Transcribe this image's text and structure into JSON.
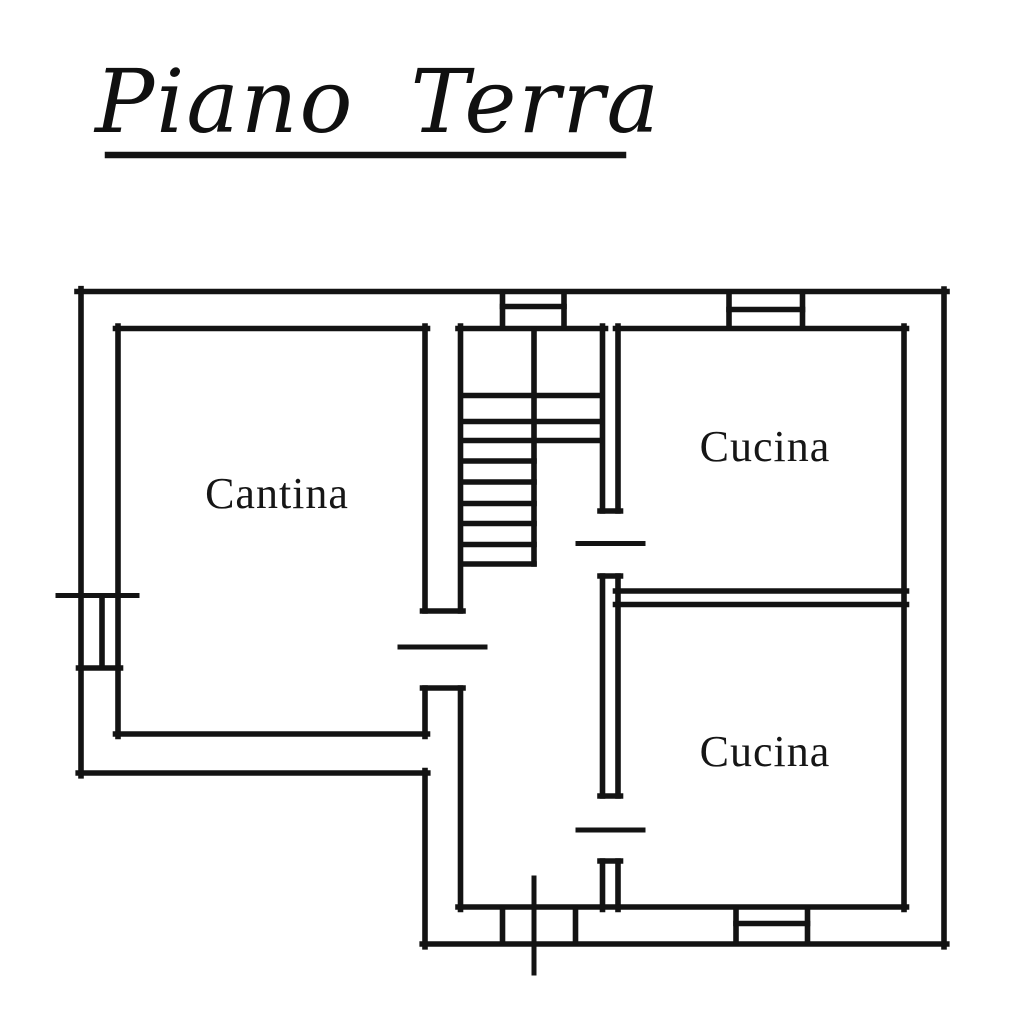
{
  "title": {
    "text": "Piano Terra"
  },
  "rooms": [
    {
      "id": "cantina",
      "label": "Cantina"
    },
    {
      "id": "cucina-top",
      "label": "Cucina"
    },
    {
      "id": "cucina-bottom",
      "label": "Cucina"
    }
  ],
  "colors": {
    "line": "#131313",
    "background": "#ffffff",
    "text": "#161616"
  },
  "plan": {
    "stroke_width": 5.6,
    "groups": {
      "title-underline": [
        [
          108,
          155,
          623,
          155,
          6.5
        ]
      ],
      "outer-walls": [
        [
          77,
          291.5,
          947,
          291.5
        ],
        [
          944,
          289,
          944,
          946.8
        ],
        [
          946.8,
          944,
          422.2,
          944
        ],
        [
          425,
          946.8,
          425,
          770.5
        ],
        [
          427.8,
          773,
          78.2,
          773
        ],
        [
          81,
          775.8,
          81,
          288.7
        ]
      ],
      "inner-walls": [
        [
          115.5,
          328.5,
          427.5,
          328.5
        ],
        [
          458,
          328.5,
          605.5,
          328.5
        ],
        [
          615.5,
          328.5,
          906.5,
          328.5
        ],
        [
          118,
          326,
          118,
          736.5
        ],
        [
          115.5,
          734,
          427.5,
          734
        ],
        [
          425,
          326,
          425,
          611
        ],
        [
          425,
          688,
          425,
          736.5
        ],
        [
          460.5,
          326,
          460.5,
          611
        ],
        [
          460.5,
          688,
          460.5,
          909.5
        ],
        [
          602.5,
          326,
          602.5,
          511
        ],
        [
          602.5,
          576,
          602.5,
          796
        ],
        [
          602.5,
          861,
          602.5,
          909.5
        ],
        [
          618,
          326,
          618,
          511
        ],
        [
          618,
          576,
          618,
          796
        ],
        [
          618,
          861,
          618,
          909.5
        ],
        [
          615.5,
          591,
          906.5,
          591
        ],
        [
          615.5,
          604.5,
          906.5,
          604.5
        ],
        [
          458,
          907,
          906.5,
          907
        ],
        [
          904,
          326,
          904,
          909.5
        ]
      ],
      "staircase": [
        [
          534,
          331,
          534,
          564
        ],
        [
          463,
          395.5,
          600,
          395.5
        ],
        [
          463,
          421.5,
          600,
          421.5
        ],
        [
          463,
          440.5,
          600,
          440.5
        ],
        [
          463,
          461,
          534,
          461
        ],
        [
          463,
          482,
          534,
          482
        ],
        [
          463,
          503.5,
          534,
          503.5
        ],
        [
          463,
          523.5,
          534,
          523.5
        ],
        [
          463,
          544.5,
          534,
          544.5
        ],
        [
          463,
          564,
          534,
          564
        ]
      ],
      "windows": [
        [
          502.5,
          294,
          502.5,
          326
        ],
        [
          564,
          294,
          564,
          326
        ],
        [
          502.5,
          306.5,
          564,
          306.5
        ],
        [
          729,
          294,
          729,
          326
        ],
        [
          802.5,
          294,
          802.5,
          326
        ],
        [
          729,
          309.5,
          802.5,
          309.5
        ],
        [
          58,
          595.5,
          137,
          595.5,
          5
        ],
        [
          102,
          598,
          102,
          665.5
        ],
        [
          78.5,
          668,
          120.5,
          668
        ],
        [
          736,
          909.5,
          736,
          941.5
        ],
        [
          807.5,
          909.5,
          807.5,
          941.5
        ],
        [
          736,
          923.5,
          807.5,
          923.5
        ]
      ],
      "doors": [
        [
          422.5,
          611,
          463,
          611
        ],
        [
          422.5,
          688,
          463,
          688
        ],
        [
          400,
          647,
          485,
          647,
          5
        ],
        [
          600,
          511,
          620.5,
          511
        ],
        [
          600,
          576,
          620.5,
          576
        ],
        [
          578,
          543.5,
          643,
          543.5,
          5
        ],
        [
          600,
          796,
          620.5,
          796
        ],
        [
          600,
          861,
          620.5,
          861
        ],
        [
          578,
          830,
          643,
          830,
          5
        ],
        [
          502.5,
          909.5,
          502.5,
          941.5
        ],
        [
          575.5,
          909.5,
          575.5,
          941.5
        ],
        [
          534,
          878,
          534,
          973,
          5
        ]
      ]
    }
  }
}
